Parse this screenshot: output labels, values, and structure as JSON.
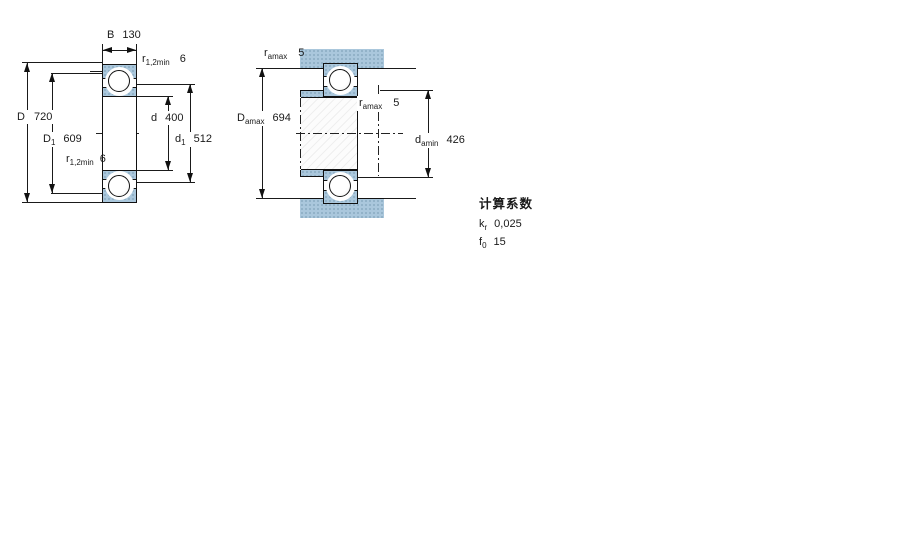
{
  "drawing": {
    "left_view": {
      "b": {
        "label": "B",
        "value": "130"
      },
      "r12_top": {
        "label": "r",
        "sub": "1,2min",
        "value": "6"
      },
      "D": {
        "label": "D",
        "value": "720"
      },
      "D1": {
        "label": "D",
        "sub": "1",
        "value": "609"
      },
      "r12_mid": {
        "label": "r",
        "sub": "1,2min",
        "value": "6"
      },
      "d": {
        "label": "d",
        "value": "400"
      },
      "d1": {
        "label": "d",
        "sub": "1",
        "value": "512"
      }
    },
    "right_view": {
      "ra_top": {
        "label": "r",
        "sub": "amax",
        "value": "5"
      },
      "Da": {
        "label": "D",
        "sub": "amax",
        "value": "694"
      },
      "ra_mid": {
        "label": "r",
        "sub": "amax",
        "value": "5"
      },
      "da": {
        "label": "d",
        "sub": "amin",
        "value": "426"
      }
    },
    "calculation_factors": {
      "heading": "计算系数",
      "kr": {
        "label": "k",
        "sub": "r",
        "value": "0,025"
      },
      "f0": {
        "label": "f",
        "sub": "0",
        "value": "15"
      }
    },
    "colors": {
      "abutment_blue": "#aac7dc",
      "line": "#1a1a1a"
    }
  }
}
